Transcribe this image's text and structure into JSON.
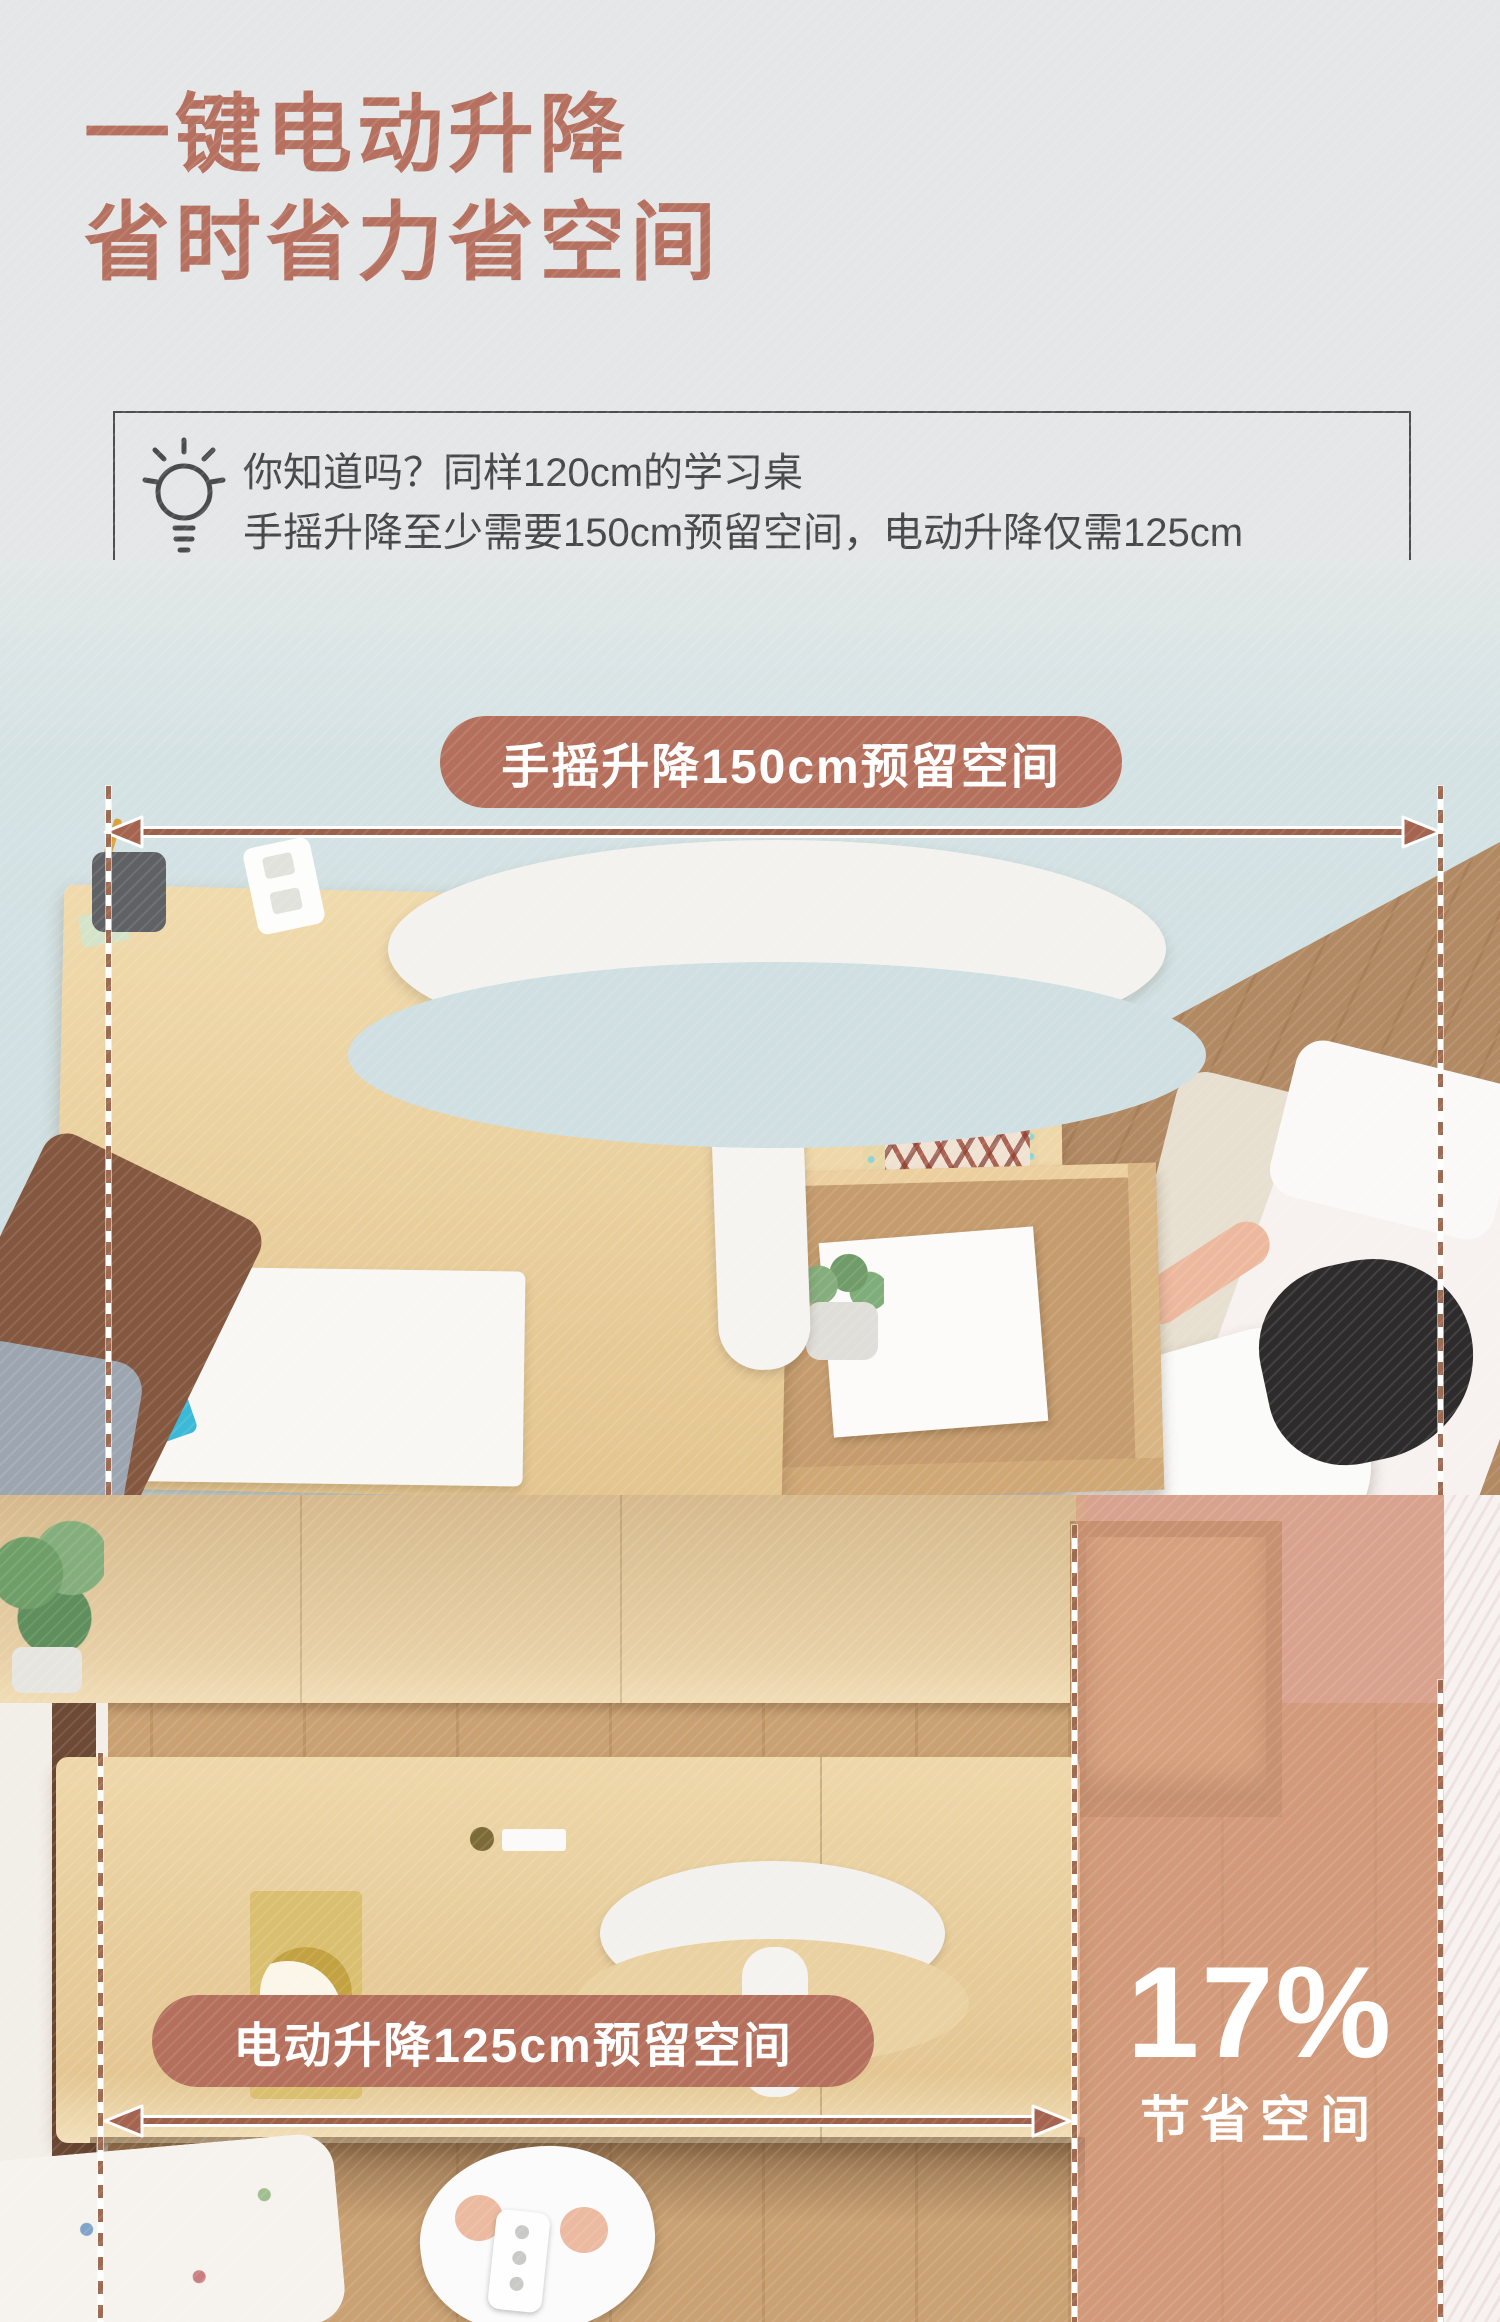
{
  "header": {
    "title_line1": "一键电动升降",
    "title_line2": "省时省力省空间"
  },
  "tip": {
    "icon": "lightbulb-icon",
    "line1": "你知道吗？同样120cm的学习桌",
    "line2": "手摇升降至少需要150cm预留空间，电动升降仅需125cm"
  },
  "annotations": {
    "crank_badge": "手摇升降150cm预留空间",
    "electric_badge": "电动升降125cm预留空间",
    "savings_value": "17%",
    "savings_caption": "节省空间"
  },
  "colors": {
    "accent_terracotta": "#b4705c",
    "title_text": "#b5705f",
    "badge_text": "#ffffff",
    "tip_text": "#484848",
    "tip_border": "#4e4e4e",
    "wall_blue": "#d3e1e3",
    "desk_wood": "#ead5a6",
    "floor_wood": "#b18963",
    "pink_overlay": "#d89580"
  }
}
